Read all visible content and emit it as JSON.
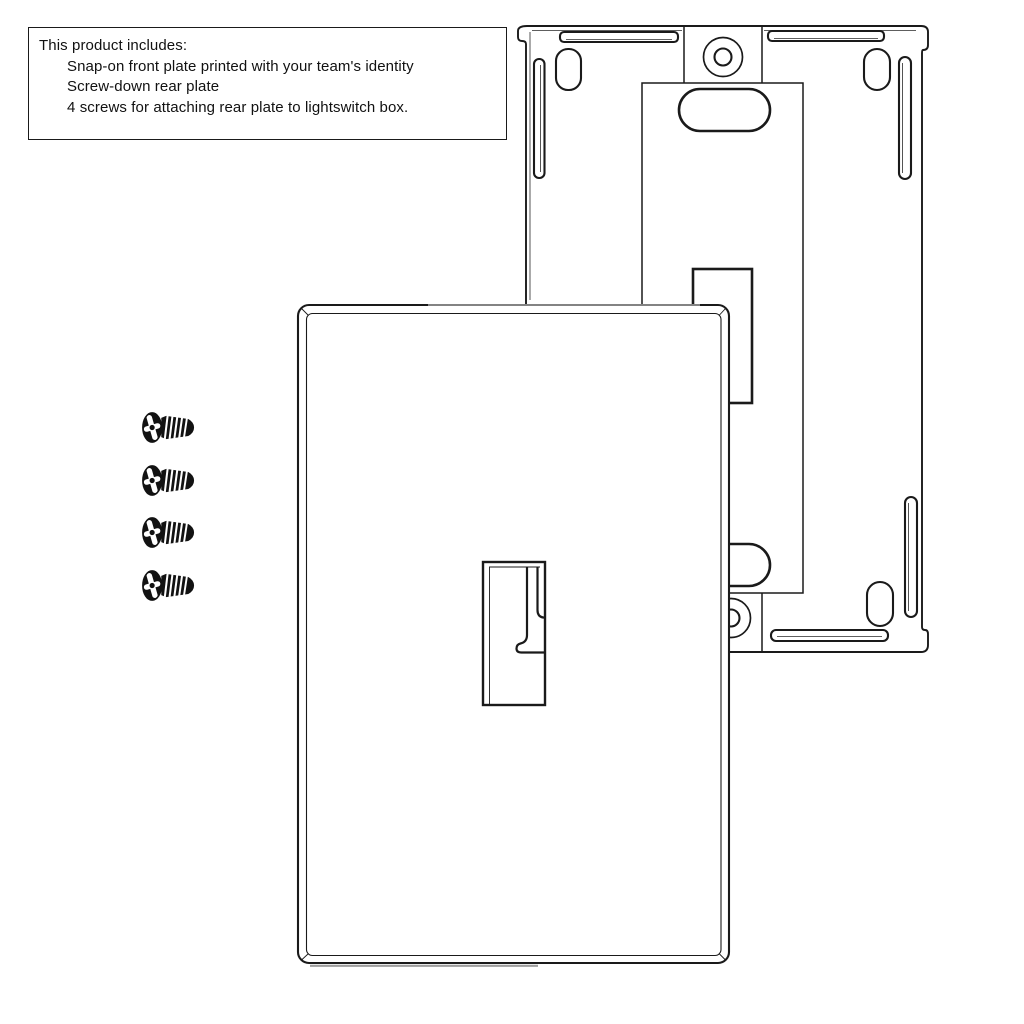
{
  "info_box": {
    "title": "This product includes:",
    "items": [
      "Snap-on front plate printed with your team's identity",
      "Screw-down rear plate",
      "4 screws for attaching rear plate to lightswitch box."
    ]
  },
  "diagram": {
    "screw_count": 4,
    "colors": {
      "line": "#1a1a1a",
      "shade": "#9e9e9e",
      "background": "#ffffff"
    }
  }
}
